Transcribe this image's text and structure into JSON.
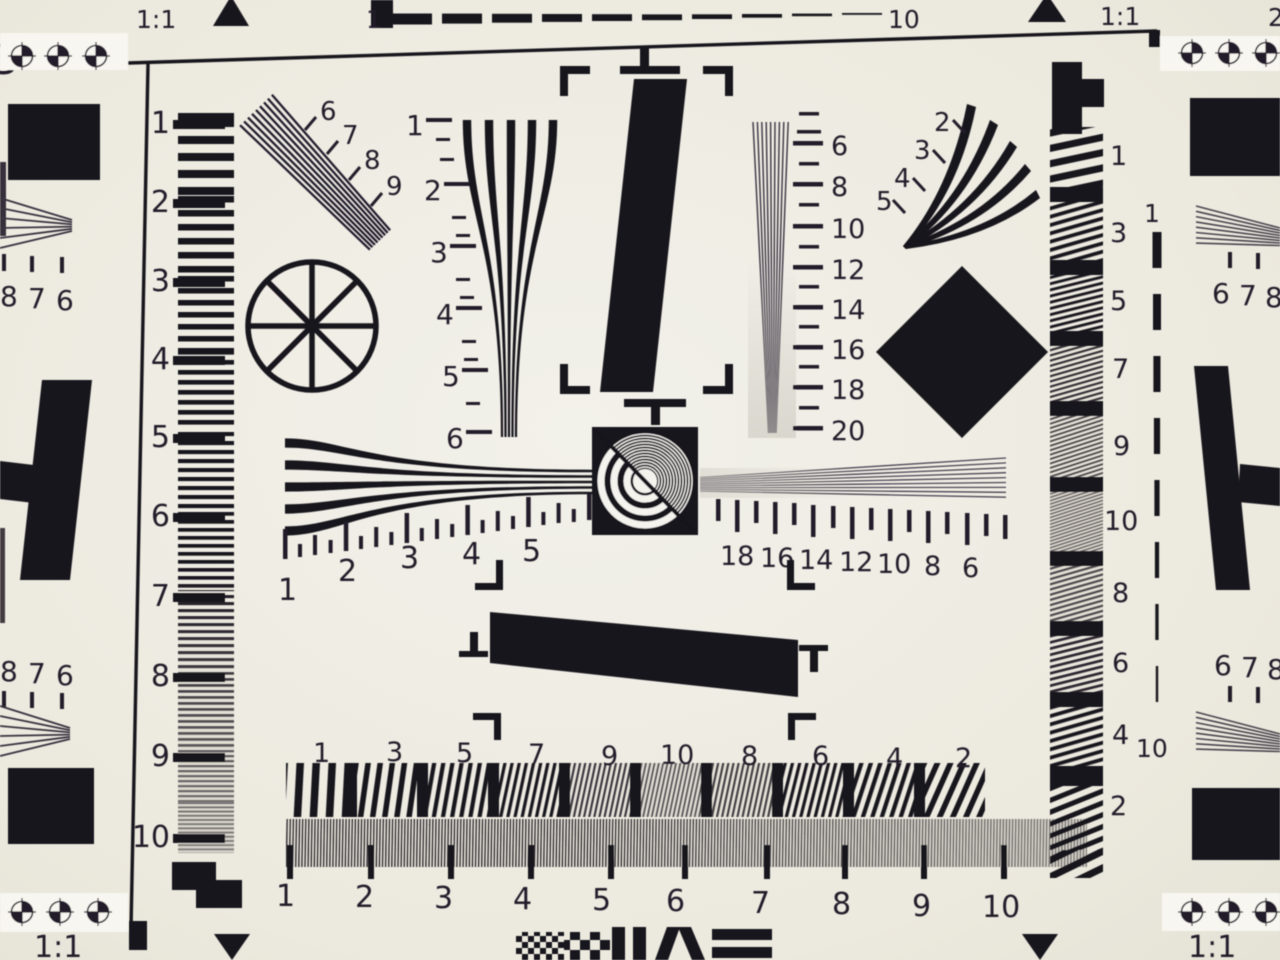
{
  "chart": {
    "title": "ISO 12233 resolution test chart (photograph)",
    "corner_scale_labels": {
      "top_left": "1:1",
      "top_right": "1:1",
      "bottom_left": "1:1",
      "bottom_right": "1:1"
    },
    "edge_partials": {
      "top_left": "3",
      "top_right": "2"
    },
    "top_dash_scale": {
      "start": "1",
      "end": "10"
    },
    "right_dash_scale": {
      "start": "1",
      "end": "10"
    },
    "left_scale": {
      "labels": [
        "1",
        "2",
        "3",
        "4",
        "5",
        "6",
        "7",
        "8",
        "9",
        "10"
      ]
    },
    "upper_left_wedge": {
      "labels": [
        "6",
        "7",
        "8",
        "9"
      ]
    },
    "left_vertical_wedge": {
      "labels": [
        "1",
        "2",
        "3",
        "4",
        "5",
        "6"
      ]
    },
    "right_vertical_wedge": {
      "labels": [
        "6",
        "8",
        "10",
        "12",
        "14",
        "16",
        "18",
        "20"
      ]
    },
    "upper_right_wedge": {
      "labels": [
        "2",
        "3",
        "4",
        "5"
      ]
    },
    "center_left_ruler": {
      "labels": [
        "1",
        "2",
        "3",
        "4",
        "5"
      ]
    },
    "center_right_ruler": {
      "labels": [
        "18",
        "16",
        "14",
        "12",
        "10",
        "8",
        "6"
      ]
    },
    "bottom_coarse_row": {
      "labels": [
        "1",
        "3",
        "5",
        "7",
        "9",
        "10",
        "8",
        "6",
        "4",
        "2"
      ]
    },
    "bottom_fine_ruler": {
      "labels": [
        "1",
        "2",
        "3",
        "4",
        "5",
        "6",
        "7",
        "8",
        "9",
        "10"
      ]
    },
    "right_strip": {
      "labels": [
        "1",
        "3",
        "5",
        "7",
        "9",
        "10",
        "8",
        "6",
        "4",
        "2"
      ]
    },
    "left_edge": {
      "upper_numbers": [
        "8",
        "7",
        "6"
      ],
      "lower_numbers": [
        "8",
        "7",
        "6"
      ]
    },
    "right_edge": {
      "upper_numbers": [
        "6",
        "7",
        "8"
      ],
      "lower_numbers": [
        "6",
        "7",
        "8"
      ]
    }
  },
  "colors": {
    "background": "#eceadf",
    "paper_white": "#f7f6f0",
    "ink": "#18121d",
    "fine_line": "#3c3644",
    "haze": "#c9c6bd"
  }
}
